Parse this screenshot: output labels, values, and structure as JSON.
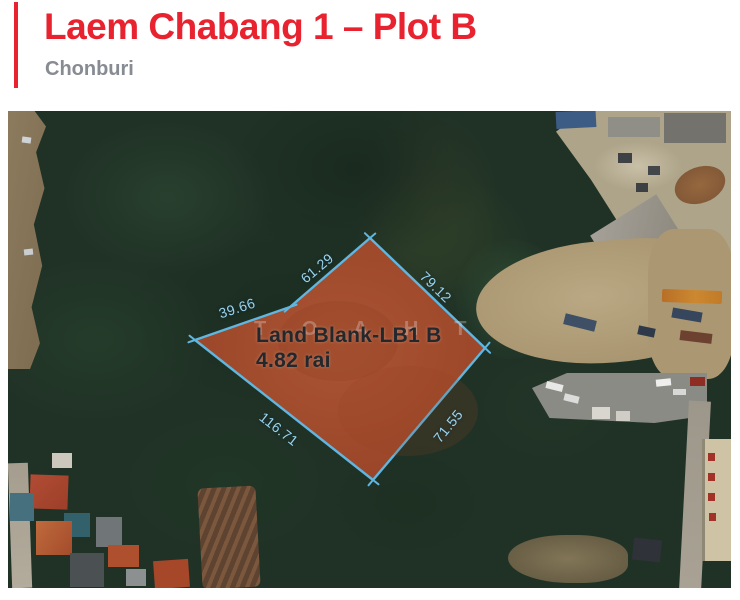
{
  "header": {
    "title": "Laem Chabang 1 – Plot B",
    "subtitle": "Chonburi"
  },
  "colors": {
    "accent": "#E8222E",
    "subtitle": "#878B92",
    "boundary": "#5FB6E0",
    "measurement": "#9BD4EF",
    "plot_fill": "#AA4B2C",
    "plot_label": "#23282D"
  },
  "map": {
    "type": "satellite",
    "plot": {
      "name": "Land Blank-LB1 B",
      "area": "4.82 rai"
    },
    "watermark": "TOAHT",
    "measurements": {
      "left": "39.66",
      "upper_left": "61.29",
      "upper_right": "79.12",
      "lower_left": "116.71",
      "lower_right": "71.55"
    }
  }
}
